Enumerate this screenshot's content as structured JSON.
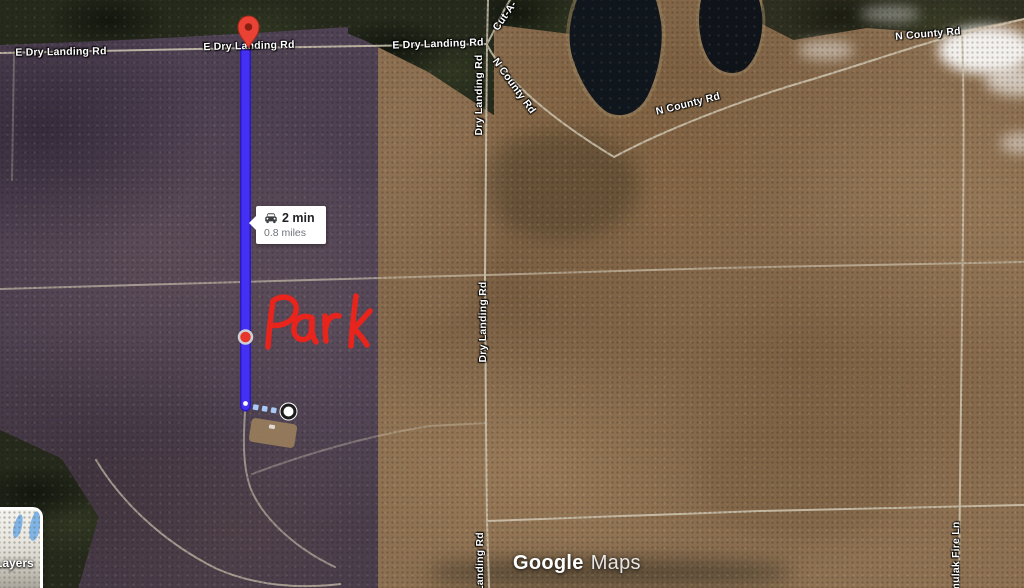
{
  "map": {
    "road_labels": [
      {
        "text": "E Dry Landing Rd"
      },
      {
        "text": "E Dry Landing Rd"
      },
      {
        "text": "E Dry Landing Rd"
      },
      {
        "text": "Cut-A-"
      },
      {
        "text": "Dry Landing Rd"
      },
      {
        "text": "N County Rd"
      },
      {
        "text": "N County Rd"
      },
      {
        "text": "N County Rd"
      },
      {
        "text": "Dry Landing Rd"
      },
      {
        "text": "Landing Rd"
      },
      {
        "text": "mulak Fire Ln"
      }
    ],
    "watermark": {
      "brand": "Google",
      "product": "Maps"
    },
    "layers_button": {
      "label": "Layers"
    }
  },
  "route": {
    "info": {
      "duration": "2 min",
      "distance": "0.8 miles"
    },
    "line_color": "#4430f2",
    "line_edge_color": "#2a18c4",
    "pin_color": "#ea4335",
    "waypoint_color": "#e6352b",
    "walk_dot_color": "#a9c9f6"
  },
  "annotation": {
    "text": "Park",
    "color": "#e8241d"
  }
}
